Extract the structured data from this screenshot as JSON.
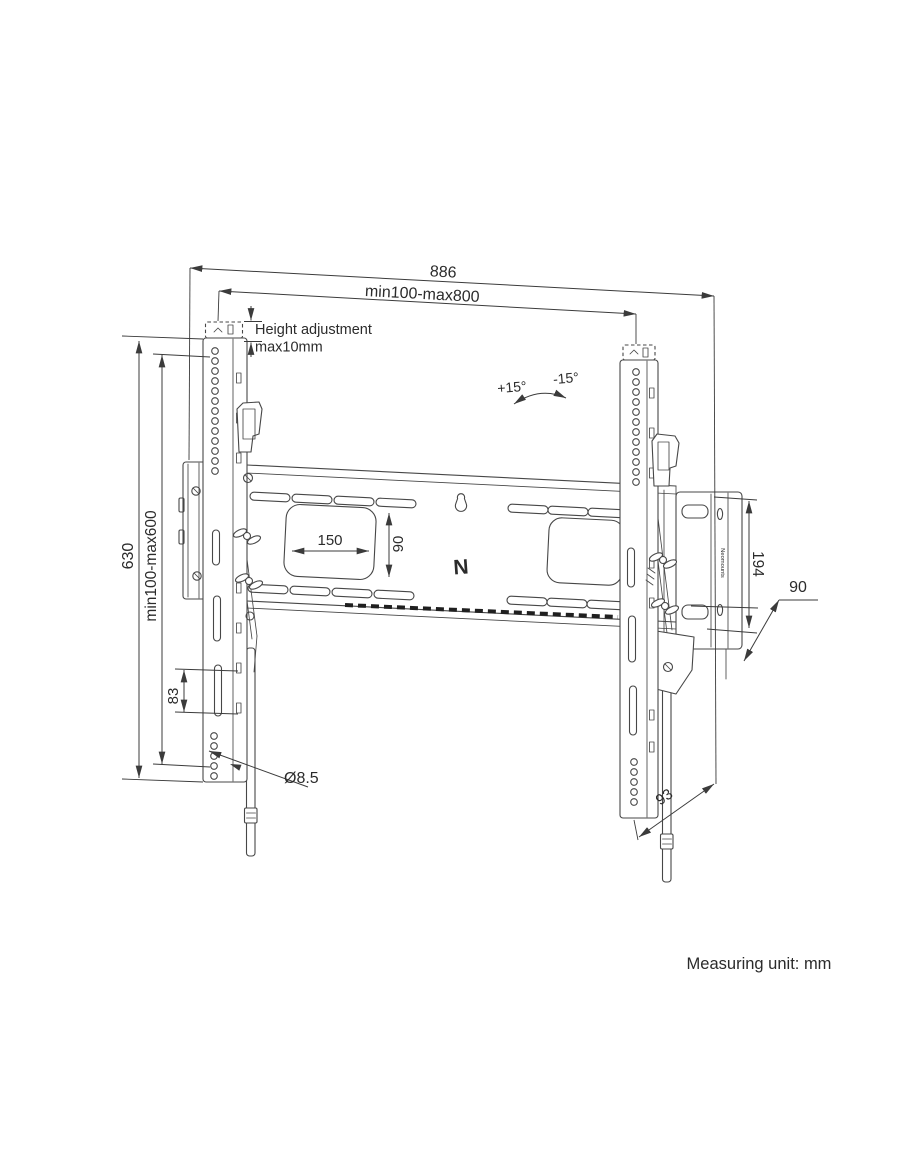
{
  "drawing": {
    "dimensions": {
      "overall_width": "886",
      "rail_span": "min100-max800",
      "height_adjustment_line1": "Height adjustment",
      "height_adjustment_line2": "max10mm",
      "tilt_up": "+15°",
      "tilt_down": "-15°",
      "overall_height": "630",
      "vesa_height": "min100-max600",
      "slot_length": "83",
      "hole_diameter": "Ø8.5",
      "cutout_width": "150",
      "cutout_height": "90",
      "wall_plate_height": "194",
      "wall_plate_depth": "90",
      "bottom_depth": "93"
    },
    "branding": {
      "logo_letter": "N",
      "brand_name": "Neomounts"
    },
    "note": "Measuring unit: mm",
    "colors": {
      "line": "#474747",
      "dimension": "#3b3b3b",
      "text": "#2b2b2b",
      "background": "#ffffff"
    }
  }
}
